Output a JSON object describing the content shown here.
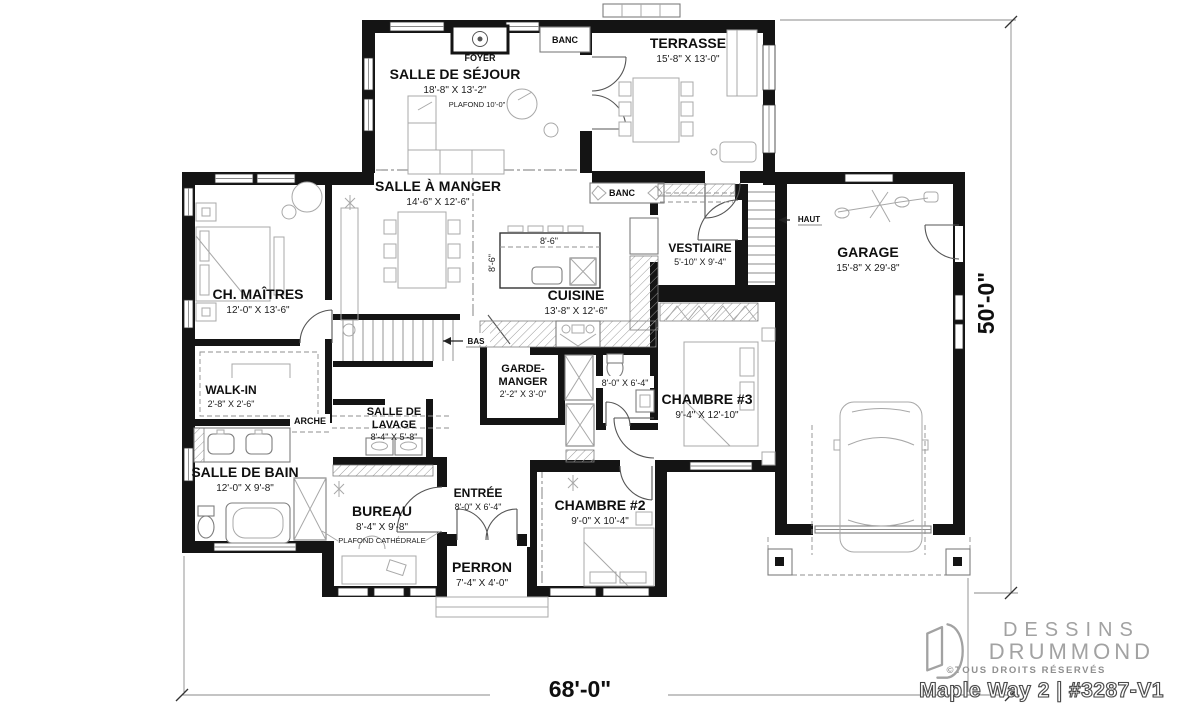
{
  "plan": {
    "dim_width": "68'-0\"",
    "dim_depth": "50'-0\"",
    "rooms": {
      "sejour": {
        "name": "SALLE DE SÉJOUR",
        "dims": "18'-8\" X 13'-2\"",
        "note": "PLAFOND 10'-0\""
      },
      "terrasse": {
        "name": "TERRASSE",
        "dims": "15'-8\" X 13'-0\""
      },
      "manger": {
        "name": "SALLE À MANGER",
        "dims": "14'-6\" X 12'-6\""
      },
      "maitres": {
        "name": "CH. MAÎTRES",
        "dims": "12'-0\" X 13'-6\""
      },
      "cuisine": {
        "name": "CUISINE",
        "dims": "13'-8\" X 12'-6\"",
        "island_w": "8'-6\"",
        "island_d": "8'-6\""
      },
      "vestiaire": {
        "name": "VESTIAIRE",
        "dims": "5'-10\" X 9'-4\""
      },
      "garage": {
        "name": "GARAGE",
        "dims": "15'-8\" X 29'-8\""
      },
      "walkin": {
        "name": "WALK-IN",
        "dims": "2'-8\" X 2'-6\""
      },
      "garde_manger": {
        "line1": "GARDE-",
        "line2": "MANGER",
        "dims": "2'-2\" X 3'-0\""
      },
      "chambre3": {
        "name": "CHAMBRE #3",
        "dims": "9'-4\" X 12'-10\""
      },
      "bain": {
        "name": "SALLE DE BAIN",
        "dims": "12'-0\" X 9'-8\""
      },
      "bain2": {
        "dims": "8'-0\" X 6'-4\""
      },
      "lavage": {
        "line1": "SALLE DE",
        "line2": "LAVAGE",
        "dims": "8'-4\" X 5'-8\""
      },
      "bureau": {
        "name": "BUREAU",
        "dims": "8'-4\" X 9'-8\"",
        "note": "PLAFOND CATHÉDRALE"
      },
      "entree": {
        "name": "ENTRÉE",
        "dims": "8'-0\" X 6'-4\""
      },
      "chambre2": {
        "name": "CHAMBRE #2",
        "dims": "9'-0\" X 10'-4\""
      },
      "perron": {
        "name": "PERRON",
        "dims": "7'-4\" X 4'-0\""
      }
    },
    "annotations": {
      "foyer": "FOYER",
      "banc_haut": "BANC",
      "banc_terrasse": "BANC",
      "arche": "ARCHE",
      "bas": "BAS",
      "haut": "HAUT"
    }
  },
  "brand": {
    "name_line1": "DESSINS",
    "name_line2": "DRUMMOND",
    "rights": "©TOUS DROITS RÉSERVÉS",
    "plan_id": "Maple Way 2 | #3287-V1"
  },
  "colors": {
    "wall": "#141414",
    "furniture": "#a8a8a8",
    "brand_gray": "#a2a2a2"
  }
}
